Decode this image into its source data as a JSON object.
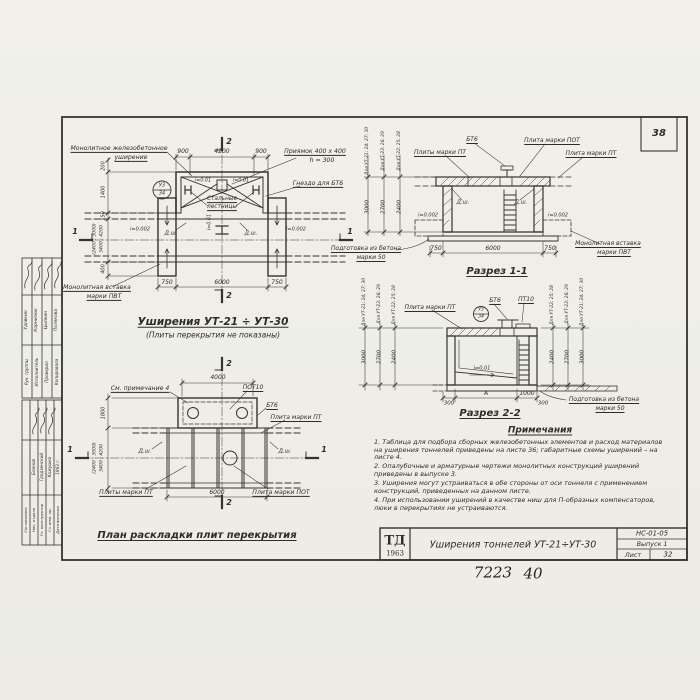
{
  "corner_number": "38",
  "common": {
    "dsh": "Д.ш.",
    "slope_001": "i=0.01",
    "slope_0002": "i=0.002",
    "group_a": "Для УТ-21; 24; 27; 30",
    "group_b": "Для УТ-23; 26; 29",
    "group_c": "Для УТ-22; 25; 28",
    "h_a": "3000",
    "h_b": "2700",
    "h_c": "2400",
    "bubble_top": "У3",
    "bubble_bottom": "34",
    "prep_line1": "Подготовка из бетона",
    "prep_line2": "марки 50",
    "insert_line1": "Монолитная вставка",
    "insert_line2": "марки ПВТ",
    "mark_1": "1",
    "mark_2": "2"
  },
  "plan": {
    "title": "Уширения УТ-21 ÷ УТ-30",
    "subtitle": "(Плиты перекрытия не показаны)",
    "callout_widening_1": "Монолитное железобетонное",
    "callout_widening_2": "уширение",
    "callout_pit_1": "Приямок 400 x 400",
    "callout_pit_2": "h = 300",
    "callout_socket": "Гнездо для БТ6",
    "callout_steel_1": "Стальные",
    "callout_steel_2": "лестницы",
    "dim_top_left": "900",
    "dim_top_mid": "4200",
    "dim_top_right": "900",
    "dim_bottom_left": "750",
    "dim_bottom_mid": "6000",
    "dim_bottom_right": "750",
    "dim_left_1": "200",
    "dim_left_2": "1400",
    "dim_left_3": "150",
    "dim_left_4a": "(2400 ; 3000)",
    "dim_left_4b": "3400 ; 4200",
    "dim_left_5": "400"
  },
  "section_1_1": {
    "title": "Разрез 1-1",
    "callout_bt6": "БТ6",
    "callout_plate_pot": "Плита марки ПОТ",
    "callout_plates_pt": "Плиты марки ПТ",
    "callout_plate_pt": "Плита марки ПТ",
    "dim_bottom_left": "750",
    "dim_bottom_mid": "6000",
    "dim_bottom_right": "750"
  },
  "section_2_2": {
    "title": "Разрез 2-2",
    "callout_plate_pt": "Плита марки ПТ",
    "callout_bt6": "БТ6",
    "callout_pt10": "ПТ10",
    "dim_1": "300",
    "dim_2": "А",
    "dim_3": "1000",
    "dim_4": "300"
  },
  "slab_plan": {
    "title": "План раскладки плит перекрытия",
    "callout_note": "См. примечание 4",
    "callout_pot10": "ПОТ10",
    "callout_bt6": "БТ6",
    "callout_plate_pt": "Плита марки ПТ",
    "callout_plates_pt": "Плиты марки ПТ",
    "callout_plate_pot": "Плита марки ПОТ",
    "dim_top": "4000",
    "dim_bottom": "6000",
    "dim_left": "1800",
    "dim_left_big_a": "(2400 ; 3000)",
    "dim_left_big_b": "3400 ; 4200"
  },
  "notes": {
    "heading": "Примечания",
    "items": [
      "1. Таблица для подбора сборных железобетонных элементов и расход материалов на уширения тоннелей приведены на листе 36; габаритные схемы уширений – на листе 4.",
      "2. Опалубочные и арматурные чертежи монолитных конструкций уширений приведены в выпуске 3.",
      "3. Уширения могут устраиваться в обе стороны от оси тоннеля с применением конструкций, приведенных на данном листе.",
      "4. При использовании уширений в качестве ниш для П-образных компенсаторов, люки в перекрытиях не устраиваются."
    ]
  },
  "title_block": {
    "logo_top": "ТД",
    "logo_year": "1963",
    "title": "Уширения тоннелей УТ-21÷УТ-30",
    "code": "НС-01-05",
    "issue": "Выпуск 1",
    "sheet_label": "Лист",
    "sheet_number": "32",
    "handwritten_1": "7223",
    "handwritten_2": "40"
  },
  "stamp": {
    "upper": [
      {
        "role": "Рук. группы",
        "name": "Удовкин"
      },
      {
        "role": "Исполнитель",
        "name": "Корнилюк"
      },
      {
        "role": "Проверил",
        "name": "Цыпкин"
      },
      {
        "role": "Копировала",
        "name": "Полякова"
      }
    ],
    "lower": [
      {
        "role": "Согласовано",
        "name": ""
      },
      {
        "role": "Нач. отдела",
        "name": "Блинов"
      },
      {
        "role": "Гл. конструктор",
        "name": "Гродзенский"
      },
      {
        "role": "Гл. инж. пр.",
        "name": "Кожушко"
      },
      {
        "role": "Дата выпуска",
        "name": "1963 г."
      }
    ]
  }
}
